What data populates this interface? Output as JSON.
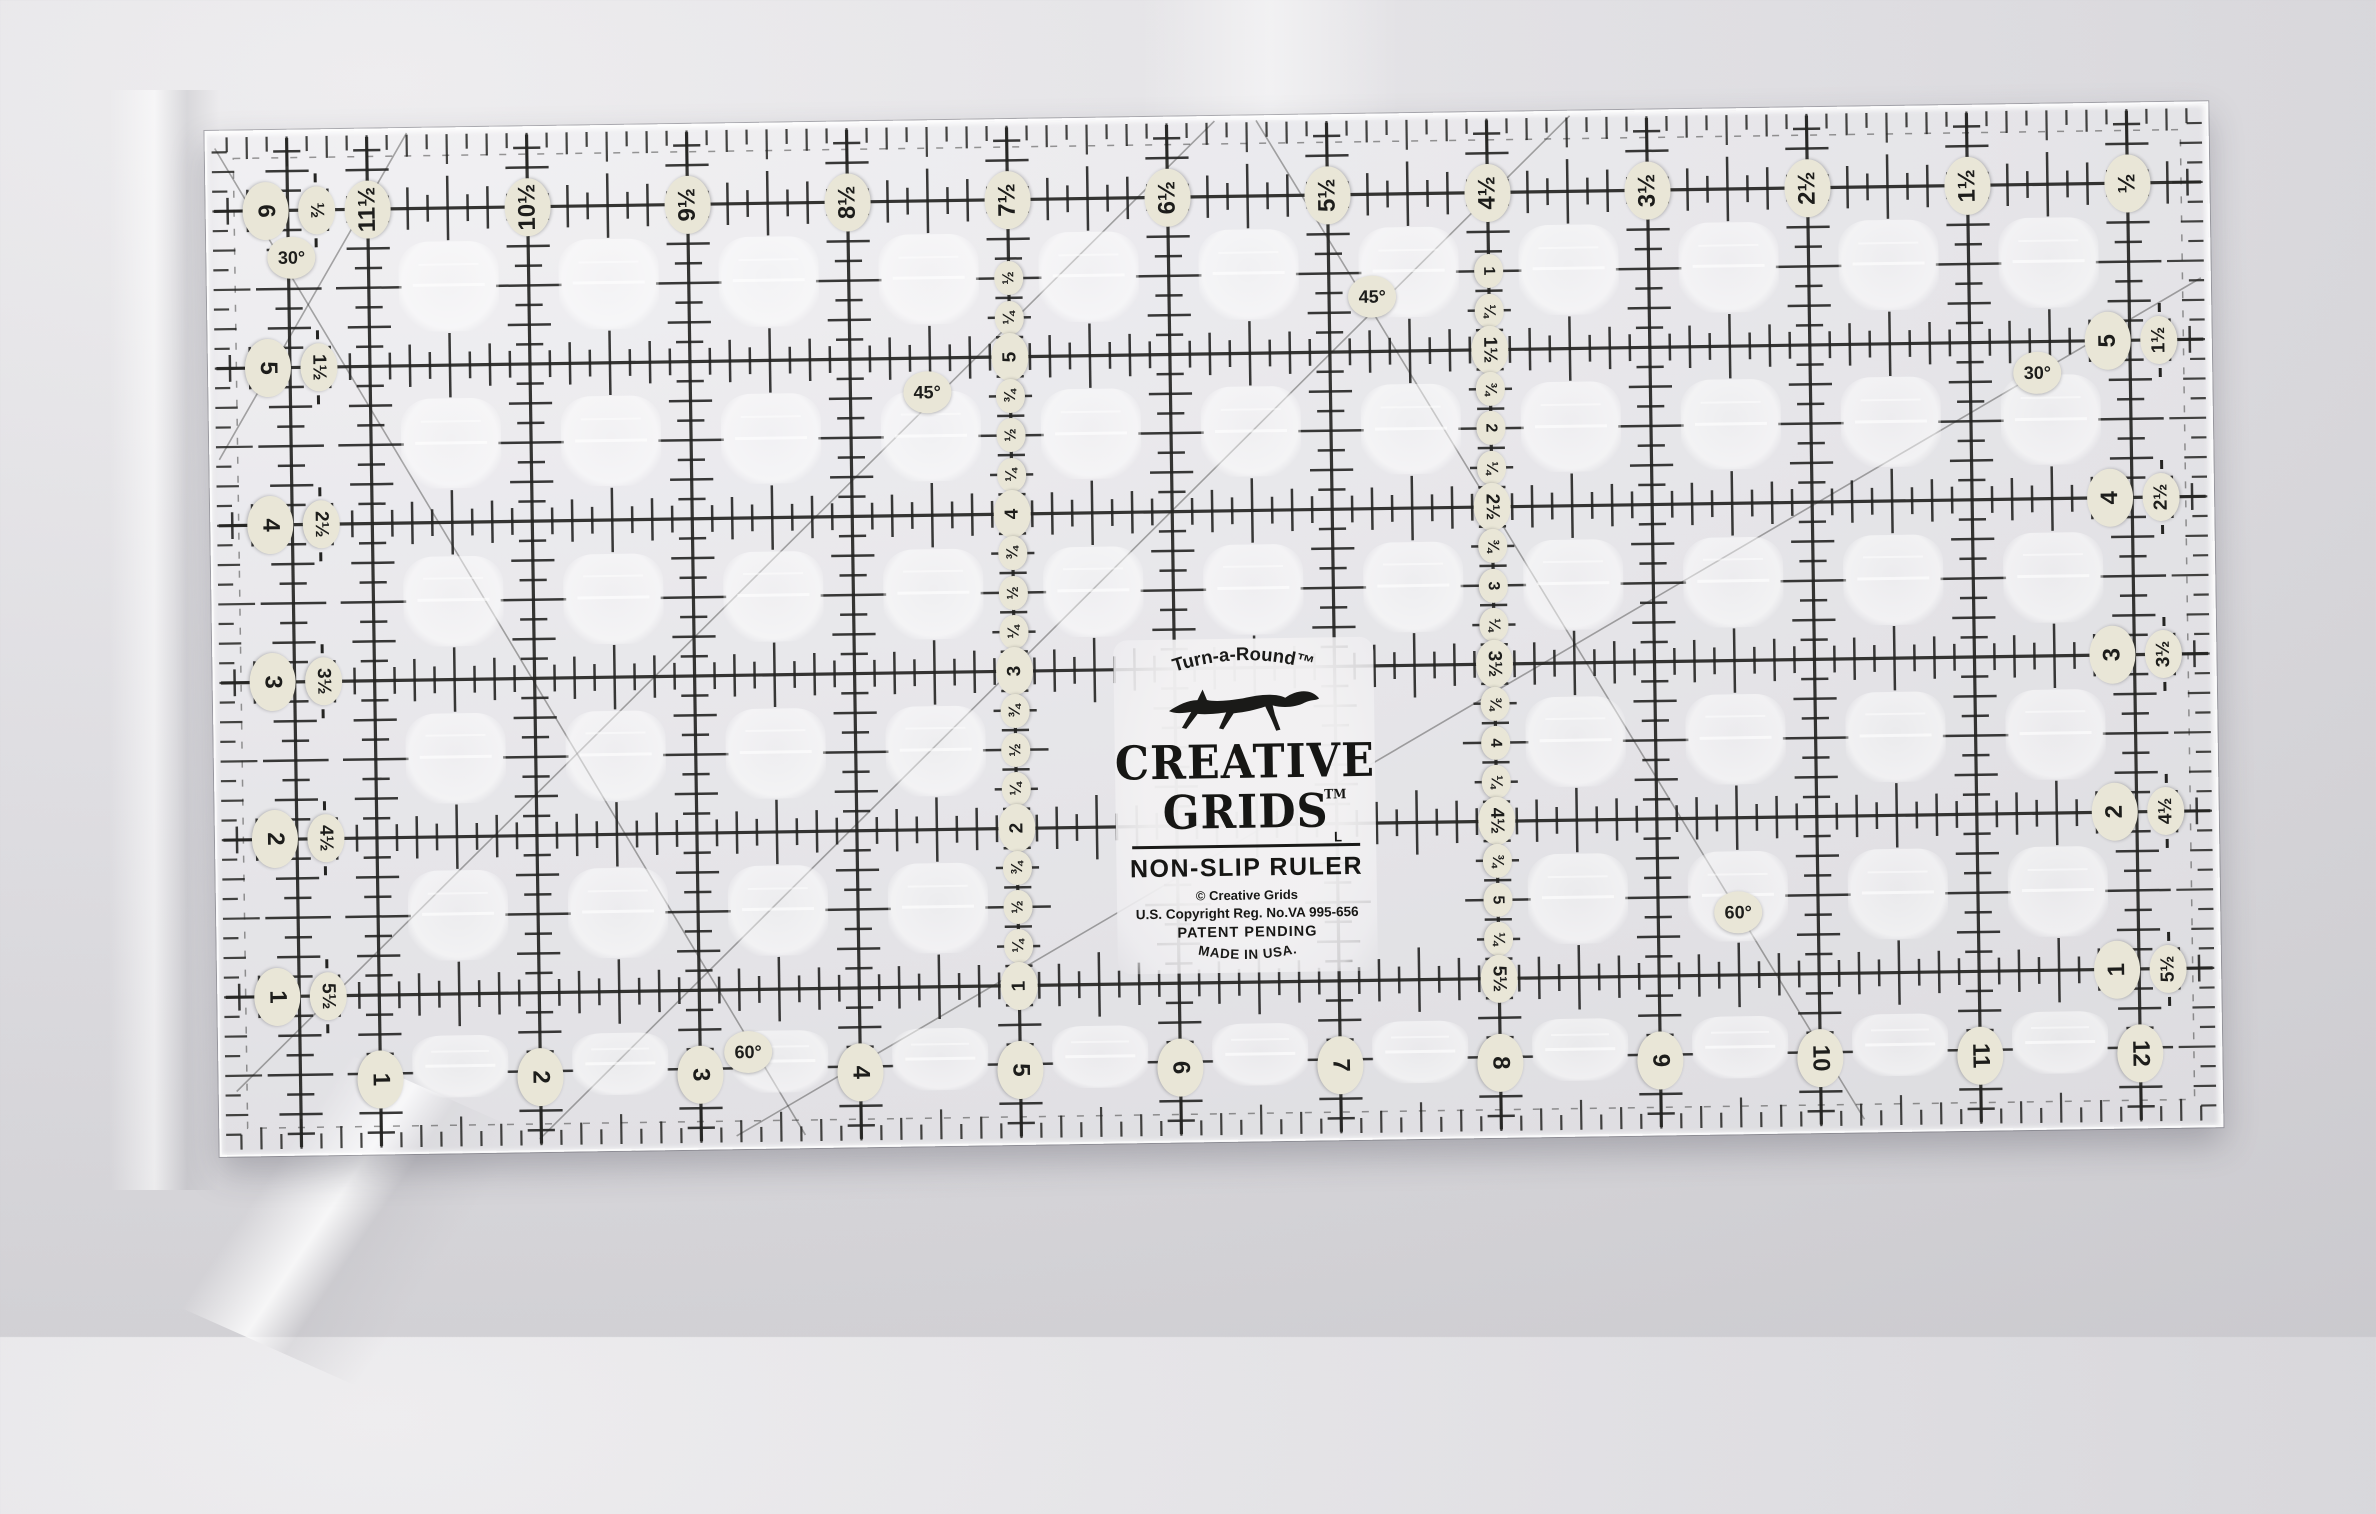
{
  "colors": {
    "fabric": "#d6d5d8",
    "ink": "#242422",
    "label_bg": "#e9e6d7",
    "label_ink": "#1d1d1b",
    "acrylic_tint": "rgba(250,250,252,0.32)",
    "edge_highlight": "rgba(255,255,255,0.85)"
  },
  "brand": {
    "tagline": "Turn-a-Round™",
    "name_line1": "CREATIVE",
    "name_line2": "GRIDS",
    "trademark": "TM",
    "l_mark": "L",
    "product": "NON-SLIP RULER",
    "copyright": "© Creative Grids",
    "registration": "U.S. Copyright Reg. No.VA 995-656",
    "patent": "PATENT PENDING",
    "made_in": "MADE IN USA."
  },
  "ruler": {
    "top_row": {
      "y": 0.5,
      "labels": [
        {
          "x": 1,
          "t": "11½"
        },
        {
          "x": 2,
          "t": "10½"
        },
        {
          "x": 3,
          "t": "9½"
        },
        {
          "x": 4,
          "t": "8½"
        },
        {
          "x": 5,
          "t": "7½"
        },
        {
          "x": 6,
          "t": "6½"
        },
        {
          "x": 7,
          "t": "5½"
        },
        {
          "x": 8,
          "t": "4½"
        },
        {
          "x": 9,
          "t": "3½"
        },
        {
          "x": 10,
          "t": "2½"
        },
        {
          "x": 11,
          "t": "1½"
        },
        {
          "x": 12,
          "t": "½"
        }
      ]
    },
    "bottom_row": {
      "y": 6.04,
      "labels": [
        {
          "x": 1,
          "t": "1"
        },
        {
          "x": 2,
          "t": "2"
        },
        {
          "x": 3,
          "t": "3"
        },
        {
          "x": 4,
          "t": "4"
        },
        {
          "x": 5,
          "t": "5"
        },
        {
          "x": 6,
          "t": "6"
        },
        {
          "x": 7,
          "t": "7"
        },
        {
          "x": 8,
          "t": "8"
        },
        {
          "x": 9,
          "t": "9"
        },
        {
          "x": 10,
          "t": "10"
        },
        {
          "x": 11,
          "t": "11"
        },
        {
          "x": 12,
          "t": "12"
        }
      ]
    },
    "left_pairs_x": {
      "main": 0.36,
      "alt": 0.68
    },
    "left_pairs": [
      {
        "y": 0.5,
        "main": "6",
        "alt": "½"
      },
      {
        "y": 1.5,
        "main": "5",
        "alt": "1½"
      },
      {
        "y": 2.5,
        "main": "4",
        "alt": "2½"
      },
      {
        "y": 3.5,
        "main": "3",
        "alt": "3½"
      },
      {
        "y": 4.5,
        "main": "2",
        "alt": "4½"
      },
      {
        "y": 5.5,
        "main": "1",
        "alt": "5½"
      }
    ],
    "right_pairs_x": {
      "main": 11.86,
      "alt": 12.18
    },
    "right_pairs": [
      {
        "y": 1.5,
        "main": "5",
        "alt": "1½"
      },
      {
        "y": 2.5,
        "main": "4",
        "alt": "2½"
      },
      {
        "y": 3.5,
        "main": "3",
        "alt": "3½"
      },
      {
        "y": 4.5,
        "main": "2",
        "alt": "4½"
      },
      {
        "y": 5.5,
        "main": "1",
        "alt": "5½"
      }
    ],
    "col_a": {
      "x": 5,
      "labels": [
        {
          "y": 1.0,
          "t": "½"
        },
        {
          "y": 1.25,
          "t": "¼"
        },
        {
          "y": 1.5,
          "t": "5"
        },
        {
          "y": 1.75,
          "t": "¾"
        },
        {
          "y": 2.0,
          "t": "½"
        },
        {
          "y": 2.25,
          "t": "¼"
        },
        {
          "y": 2.5,
          "t": "4"
        },
        {
          "y": 2.75,
          "t": "¾"
        },
        {
          "y": 3.0,
          "t": "½"
        },
        {
          "y": 3.25,
          "t": "¼"
        },
        {
          "y": 3.5,
          "t": "3"
        },
        {
          "y": 3.75,
          "t": "¾"
        },
        {
          "y": 4.0,
          "t": "½"
        },
        {
          "y": 4.25,
          "t": "¼"
        },
        {
          "y": 4.5,
          "t": "2"
        },
        {
          "y": 4.75,
          "t": "¾"
        },
        {
          "y": 5.0,
          "t": "½"
        },
        {
          "y": 5.25,
          "t": "¼"
        },
        {
          "y": 5.5,
          "t": "1"
        }
      ]
    },
    "col_b": {
      "x": 8,
      "labels": [
        {
          "y": 1.0,
          "t": "1"
        },
        {
          "y": 1.25,
          "t": "¼"
        },
        {
          "y": 1.5,
          "t": "1½"
        },
        {
          "y": 1.75,
          "t": "¾"
        },
        {
          "y": 2.0,
          "t": "2"
        },
        {
          "y": 2.25,
          "t": "¼"
        },
        {
          "y": 2.5,
          "t": "2½"
        },
        {
          "y": 2.75,
          "t": "¾"
        },
        {
          "y": 3.0,
          "t": "3"
        },
        {
          "y": 3.25,
          "t": "¼"
        },
        {
          "y": 3.5,
          "t": "3½"
        },
        {
          "y": 3.75,
          "t": "¾"
        },
        {
          "y": 4.0,
          "t": "4"
        },
        {
          "y": 4.25,
          "t": "¼"
        },
        {
          "y": 4.5,
          "t": "4½"
        },
        {
          "y": 4.75,
          "t": "¾"
        },
        {
          "y": 5.0,
          "t": "5"
        },
        {
          "y": 5.25,
          "t": "¼"
        },
        {
          "y": 5.5,
          "t": "5½"
        }
      ]
    },
    "angle_labels": [
      {
        "text": "30°",
        "x": 0.52,
        "y": 0.8
      },
      {
        "text": "45°",
        "x": 4.48,
        "y": 1.72
      },
      {
        "text": "45°",
        "x": 7.27,
        "y": 1.15
      },
      {
        "text": "30°",
        "x": 11.42,
        "y": 1.7
      },
      {
        "text": "60°",
        "x": 3.3,
        "y": 5.9
      },
      {
        "text": "60°",
        "x": 9.5,
        "y": 5.1
      }
    ]
  }
}
